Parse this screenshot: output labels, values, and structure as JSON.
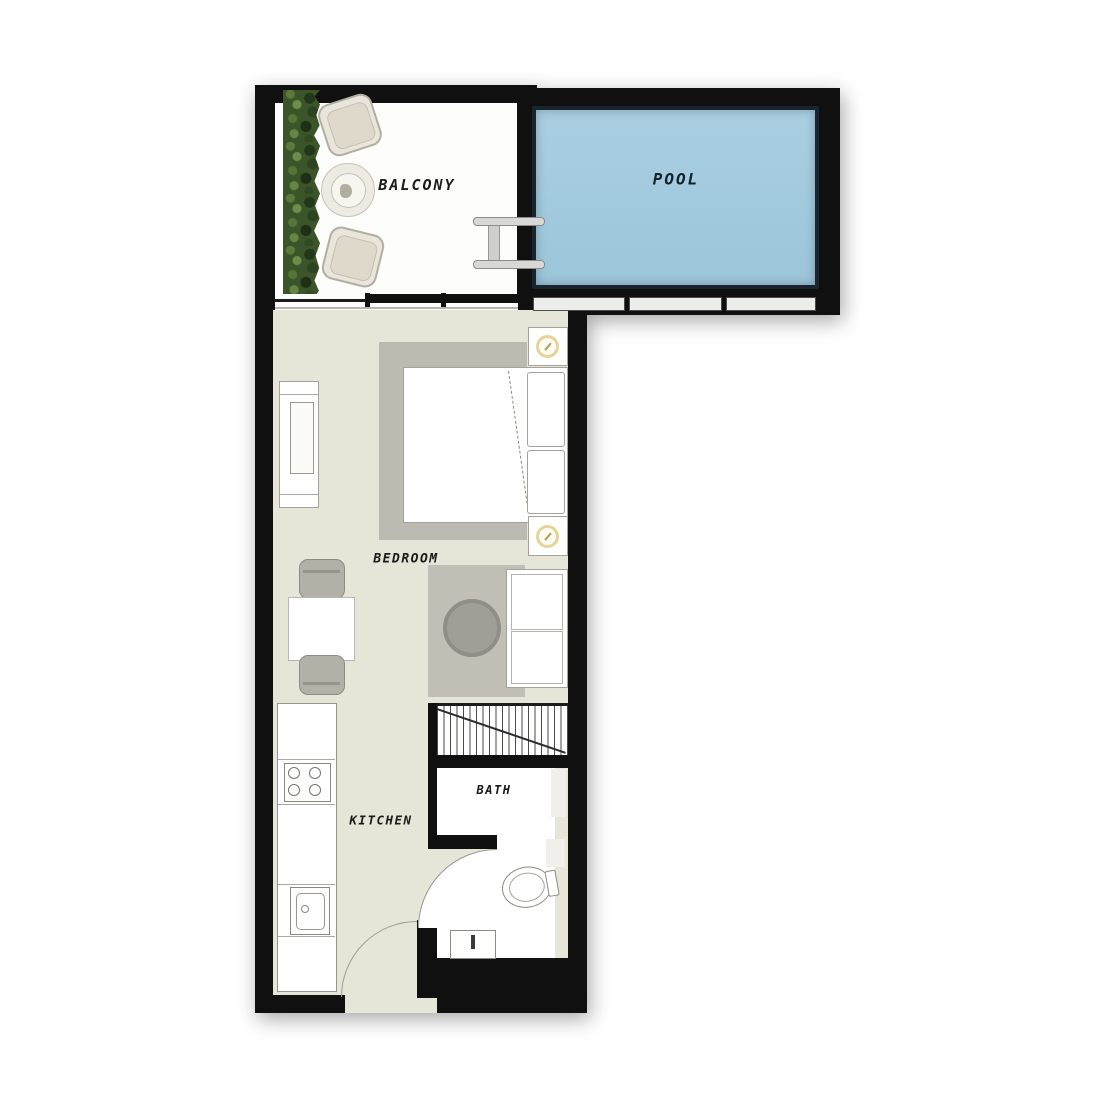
{
  "title": "Studio Apartment Floor Plan",
  "labels": {
    "balcony": "BALCONY",
    "pool": "POOL",
    "bedroom": "BEDROOM",
    "kitchen": "KITCHEN",
    "bath": "BATH"
  },
  "rooms": [
    {
      "name": "balcony"
    },
    {
      "name": "pool"
    },
    {
      "name": "bedroom"
    },
    {
      "name": "kitchen"
    },
    {
      "name": "bath"
    }
  ],
  "colors": {
    "wall": "#101010",
    "floor_main": "#e6e6d8",
    "floor_white": "#fdfdfc",
    "pool_water": "#9cc5da",
    "pool_water_light": "#a9cfe1",
    "pool_edge": "#18242e",
    "pool_text": "#13222e",
    "label_text": "#1b1b1b",
    "rug": "#bcbab1",
    "rug_tv": "#c0beb5",
    "pouf": "#a09f97",
    "furniture_border": "#a4a29a",
    "chair_fill": "#e9e5da",
    "chair_border": "#b3aea1",
    "gray_chair": "#b2b1a8",
    "lamp_ring": "#e5d498",
    "hedge_base": "#3c5429",
    "railing_fill": "#ededeb",
    "ladder_fill": "#d8d8d6",
    "arc_line": "#9a988e"
  }
}
